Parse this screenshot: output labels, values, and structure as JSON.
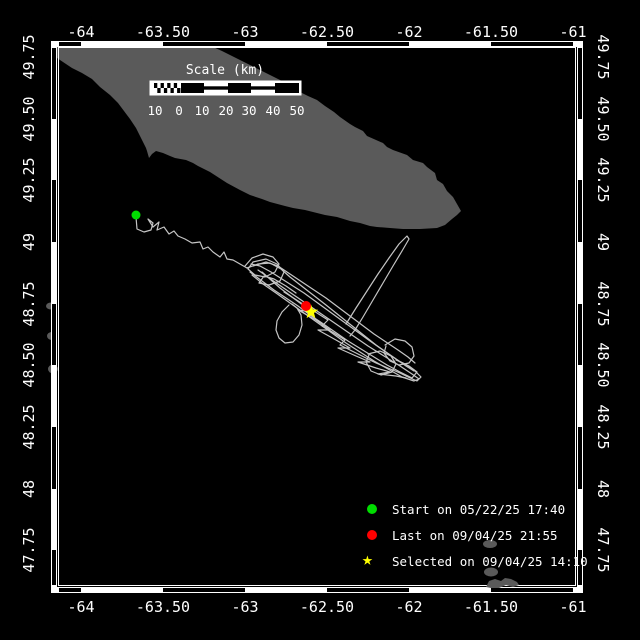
{
  "colors": {
    "background": "#000000",
    "frame": "#ffffff",
    "land": "#5a5a5a",
    "track": "#c5c5c5",
    "start_marker": "#00dd00",
    "last_marker": "#ff0000",
    "selected_marker": "#ffff00",
    "text": "#ffffff"
  },
  "axes": {
    "lon_labels": [
      "-64",
      "-63.50",
      "-63",
      "-62.50",
      "-62",
      "-61.50",
      "-61"
    ],
    "lat_labels": [
      "49.75",
      "49.50",
      "49.25",
      "49",
      "48.75",
      "48.50",
      "48.25",
      "48",
      "47.75"
    ]
  },
  "scale_bar": {
    "title": "Scale (km)",
    "ticks": [
      "10",
      "0",
      "10",
      "20",
      "30",
      "40",
      "50"
    ]
  },
  "legend": {
    "items": [
      {
        "marker": "circle",
        "color": "#00dd00",
        "label": "Start on 05/22/25 17:40"
      },
      {
        "marker": "circle",
        "color": "#ff0000",
        "label": "Last on 09/04/25 21:55"
      },
      {
        "marker": "star",
        "color": "#ffff00",
        "label": "Selected on 09/04/25 14:10"
      }
    ]
  },
  "map": {
    "land_polygon": "57,47 213,47 222,51 232,56 240,60 250,65 258,69 268,74 280,80 290,86 300,92 308,96 317,100 325,106 334,112 340,117 350,124 355,127 363,131 367,136 383,143 387,147 393,150 407,155 413,160 423,163 427,167 435,173 437,180 443,184 447,191 453,197 457,204 461,211 457,215 452,219 445,225 437,228 420,229 403,229 390,228 377,227 370,226 360,223 350,221 337,217 325,215 313,212 305,210 293,208 285,206 270,202 262,199 250,195 240,190 227,183 210,172 198,166 193,163 186,160 175,158 170,156 163,153 156,151 152,154 149,158 147,151 146,148 141,138 136,128 130,119 124,111 118,103 110,95 100,87 92,79 82,73 72,68 63,62 57,58",
    "islets_under": [
      {
        "cx": 51,
        "cy": 306,
        "rx": 5,
        "ry": 3.5
      },
      {
        "cx": 52,
        "cy": 336,
        "rx": 5,
        "ry": 4
      },
      {
        "cx": 53,
        "cy": 369,
        "rx": 5,
        "ry": 4.5
      },
      {
        "cx": 490,
        "cy": 544,
        "rx": 7,
        "ry": 4
      },
      {
        "cx": 491,
        "cy": 572,
        "rx": 7,
        "ry": 4.5
      }
    ],
    "islet_over_polygon": "486,587 489,581 495,579 501,581 505,578 511,579 517,582 519,585 513,587 506,585 499,588 491,588",
    "track_lines": [
      "136,217 137,229 144,232 151,230 153,223 148,219 153,227 159,222 157,230 164,227 169,234 174,231 178,236 185,239 192,243 200,242 203,249 208,247 213,252 220,257 224,252 227,259 233,260 240,264 247,268",
      "245,266 252,258 263,254 273,257 279,264 275,272 265,277 255,275 248,269 253,262 266,259 277,264 284,272 280,281 269,285 259,283 264,276 274,279 286,286 296,293",
      "247,268 258,264 270,263 281,269 290,277 299,284 308,291 317,298 326,305 336,313 346,321 356,329 366,337 376,345 386,352 396,359 406,366 414,371",
      "250,272 262,281 274,290 286,298 298,306 310,315 322,323 335,332 348,341 361,349 374,357 387,365 400,372 412,378 417,372 409,366 399,361 390,355 380,348 370,341 359,333 348,325 337,317 326,309 315,301 304,293 293,286 282,279 271,272 260,266 251,264",
      "258,270 272,280 288,291 304,302 320,313 336,324 352,335 368,346 384,356 400,366 412,374 419,379 414,381 402,377 388,369 374,361 360,352 346,343 332,333 318,323 304,313 290,303 276,293 263,284 252,275",
      "262,272 280,288 296,300 312,312 298,310 316,320 330,330 318,330 336,340 350,348 338,348 356,356 370,362 358,362 376,368 390,372 378,374 396,376 406,378",
      "289,305 282,312 277,321 276,330 279,338 285,343 293,342 299,335 302,325 301,315 297,308 292,304",
      "346,324 356,308 367,291 378,274 389,258 399,244 407,236 409,239 402,251 393,266 383,283 373,300 363,317 355,330 350,336",
      "385,345 395,339 405,341 412,347 414,356 409,363 399,365 390,361 384,353 386,346",
      "368,354 380,351 391,356 396,364 392,372 381,375 371,371 366,362 369,355",
      "398,372 408,377 417,381 421,377 414,370 405,364 396,360",
      "284,292 295,299 306,306 317,313 328,320 322,326 334,333 345,340 340,345 352,351 364,357 376,363 388,368 400,373",
      "253,266 266,262 278,266 290,274 302,282 314,290 326,298 338,307 350,316 362,325 374,334 386,342 398,350 408,357 415,363"
    ],
    "markers": {
      "start": {
        "x": 136,
        "y": 215,
        "r": 4.5,
        "color": "#00dd00"
      },
      "last": {
        "x": 306,
        "y": 306,
        "r": 5,
        "color": "#ff0000"
      },
      "selected": {
        "x": 311,
        "y": 312,
        "R": 7.5,
        "r2": 3.2,
        "color": "#ffff00"
      }
    }
  }
}
